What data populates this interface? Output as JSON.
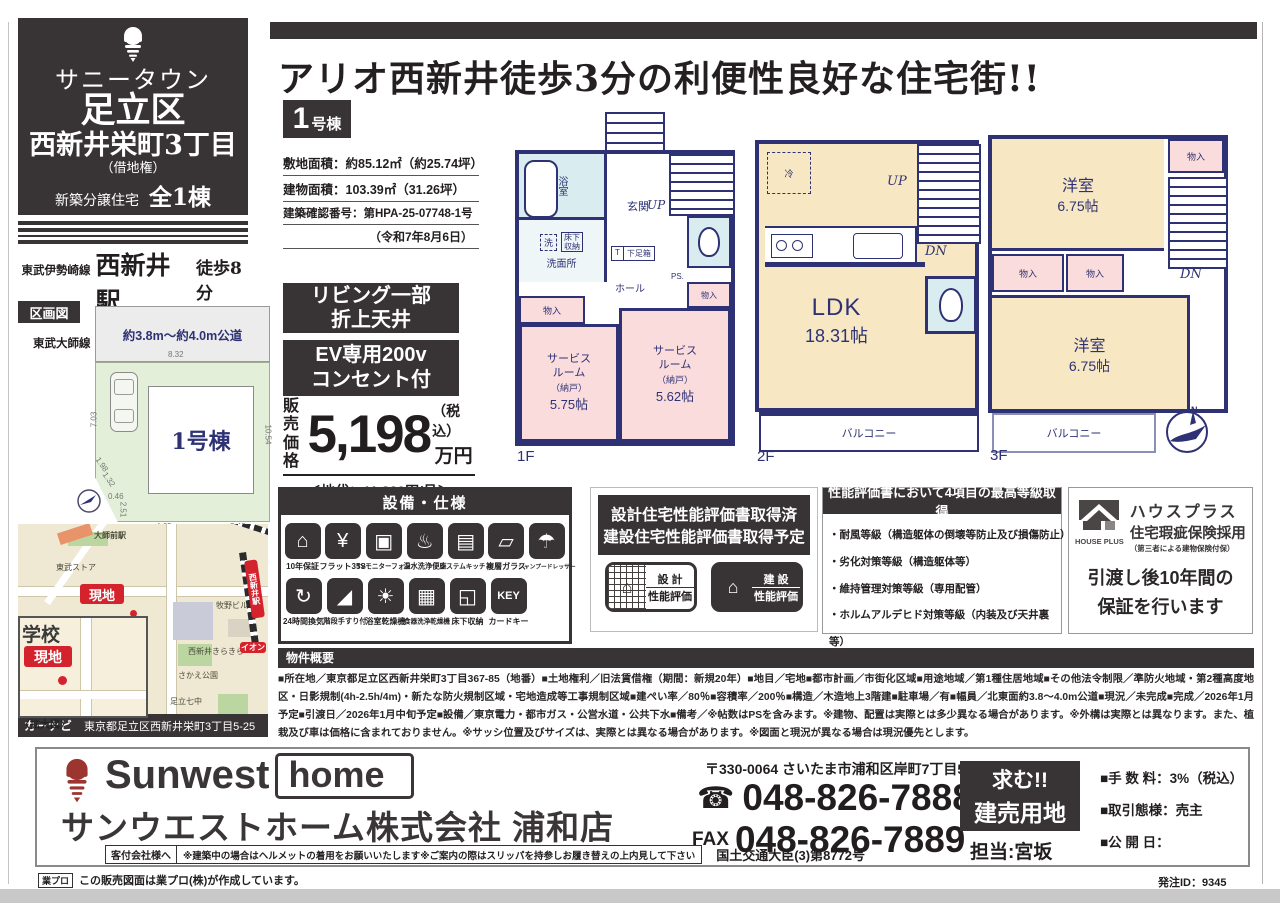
{
  "page": {
    "order_id": "発注ID：9345"
  },
  "sidebar": {
    "project_name": "サニータウン",
    "area": "足立区",
    "town": "西新井栄町3丁目",
    "leasehold": "（借地権）",
    "type_label": "新築分譲住宅",
    "total_label": "全1棟",
    "stations": [
      {
        "line": "東武伊勢崎線",
        "station": "西新井駅",
        "walk": "徒歩8分"
      },
      {
        "line": "東武大師線",
        "station": "大師前駅",
        "walk": "徒歩6分"
      }
    ],
    "plot": {
      "section_label": "区画図",
      "road_label": "約3.8m～約4.0m公道",
      "building_label": "1号棟",
      "dims": [
        "8.32",
        "7.03",
        "10.54",
        "4.65",
        "2.42",
        "1.98",
        "1.32",
        "0.46",
        "2.51"
      ]
    },
    "map": {
      "station1": "大師前駅",
      "station2": "西新井駅",
      "labels": [
        "東武ストア",
        "アーク東山クリニック",
        "牧野ビル",
        "西新井きらきら",
        "さかえ公園",
        "足立七中"
      ],
      "ion": "イオン",
      "site_label": "現地",
      "school_label": "学校",
      "enlarge_label": "〈拡大図〉",
      "navi_label": "カーナビ",
      "navi_address": "東京都足立区西新井栄町3丁目5-25"
    }
  },
  "main": {
    "headline": "アリオ西新井徒歩3分の利便性良好な住宅街!!",
    "unit_num": "1",
    "unit_suffix": "号棟",
    "specs": [
      "敷地面積：約85.12㎡（約25.74坪）",
      "建物面積：103.39㎡（31.26坪）",
      "建築確認番号：第HPA-25-07748-1号",
      "（令和7年8月6日）"
    ],
    "feature_boxes": [
      "リビング一部\n折上天井",
      "EV専用200v\nコンセント付"
    ],
    "price": {
      "label": "販売\n価格",
      "amount": "5,198",
      "tax": "（税込）",
      "unit": "万円",
      "land_rent": "＜地代：11,820円/月＞"
    }
  },
  "fp1": {
    "floor": "1F",
    "bath": "浴室",
    "wash": "洗",
    "underfloor": "床下\n収納",
    "washroom": "洗面所",
    "genkan": "玄関",
    "t": "T",
    "shoebox": "下足箱",
    "up": "UP",
    "hall": "ホール",
    "ps": "PS.",
    "closet1": "物入",
    "closet2": "物入",
    "sr1_name": "サービス\nルーム",
    "sr1_sub": "（納戸）",
    "sr1_size": "5.75帖",
    "sr2_name": "サービス\nルーム",
    "sr2_sub": "（納戸）",
    "sr2_size": "5.62帖"
  },
  "fp2": {
    "floor": "2F",
    "fridge": "冷",
    "up": "UP",
    "dn": "DN",
    "ldk_name": "LDK",
    "ldk_size": "18.31帖",
    "balcony": "バルコニー"
  },
  "fp3": {
    "floor": "3F",
    "room1_name": "洋室",
    "room1_size": "6.75帖",
    "room2_name": "洋室",
    "room2_size": "6.75帖",
    "closet1": "物入",
    "closet2": "物入",
    "closet3": "物入",
    "dn": "DN",
    "balcony": "バルコニー",
    "compass_n": "N"
  },
  "equipment": {
    "header": "設備・仕様",
    "row1": [
      {
        "label": "10年保証",
        "glyph": "⌂"
      },
      {
        "label": "フラット35S",
        "glyph": "¥"
      },
      {
        "label": "TVモニターフォン",
        "glyph": "▣"
      },
      {
        "label": "温水洗浄便座",
        "glyph": "♨"
      },
      {
        "label": "システムキッチン",
        "glyph": "▤"
      },
      {
        "label": "複層ガラス",
        "glyph": "▱"
      },
      {
        "label": "シャンプードレッサー",
        "glyph": "☂"
      }
    ],
    "row2": [
      {
        "label": "24時間換気",
        "glyph": "↻"
      },
      {
        "label": "階段手すり付",
        "glyph": "◢"
      },
      {
        "label": "浴室乾燥機",
        "glyph": "☀"
      },
      {
        "label": "食器洗浄乾燥機",
        "glyph": "▦"
      },
      {
        "label": "床下収納",
        "glyph": "◱"
      },
      {
        "label": "カードキー",
        "glyph": "KEY"
      }
    ]
  },
  "evaluation": {
    "line1": "設計住宅性能評価書取得済",
    "line2": "建設住宅性能評価書取得予定",
    "badge1_top": "設 計",
    "badge1_bottom": "性能評価",
    "badge2_top": "建 設",
    "badge2_bottom": "性能評価"
  },
  "grades": {
    "header": "性能評価書において4項目の最高等級取得",
    "items": [
      "・耐風等級（構造躯体の倒壊等防止及び損傷防止）",
      "・劣化対策等級（構造躯体等）",
      "・維持管理対策等級（専用配管）",
      "・ホルムアルデヒド対策等級（内装及び天井裏等）"
    ]
  },
  "warranty": {
    "logo_text": "HOUSE PLUS",
    "line1": "ハウスプラス",
    "line2": "住宅瑕疵保険採用",
    "line3": "（第三者による建物保険付保）",
    "body": "引渡し後10年間の\n保証を行います"
  },
  "overview": {
    "header": "物件概要",
    "text": "■所在地／東京都足立区西新井栄町3丁目367-85（地番）■土地権利／旧法賃借権（期間：新規20年）■地目／宅地■都市計画／市街化区域■用途地域／第1種住居地域■その他法令制限／準防火地域・第2種高度地区・日影規制(4h-2.5h/4m)・新たな防火規制区域・宅地造成等工事規制区域■建ぺい率／80％■容積率／200％■構造／木造地上3階建■駐車場／有■幅員／北東面約3.8～4.0m公道■現況／未完成■完成／2026年1月予定■引渡日／2026年1月中旬予定■設備／東京電力・都市ガス・公営水道・公共下水■備考／※帖数はPSを含みます。※建物、配置は実際とは多少異なる場合があります。※外構は実際とは異なります。また、植栽及び車は価格に含まれておりません。※サッシ位置及びサイズは、実際とは異なる場合があります。※図面と現況が異なる場合は現況優先とします。"
  },
  "footer": {
    "logo_en1": "Sunwest",
    "logo_en2": "home",
    "company": "サンウエストホーム株式会社 浦和店",
    "notice_label": "客付会社様へ",
    "notice": "※建築中の場合はヘルメットの着用をお願いいたします※ご案内の際はスリッパを持参しお履き替えの上内見して下さい",
    "license": "国土交通大臣(3)第8772号",
    "postal": "〒330-0064 さいたま市浦和区岸町7丁目5-4",
    "tel_icon": "☎",
    "tel": "048-826-7888",
    "fax_label": "FAX",
    "fax": "048-826-7889",
    "want_line1": "求む!!",
    "want_line2": "建売用地",
    "contact": "担当:宮坂",
    "fee": "■手 数 料：3%（税込）",
    "deal": "■取引態様：売主",
    "open_date": "■公 開 日：",
    "credit_logo": "業プロ",
    "credit": "この販売図面は業プロ(株)が作成しています。"
  },
  "colors": {
    "accent_black": "#383334",
    "plan_navy": "#2e3274",
    "room_cream": "#f7e7c2",
    "room_pink": "#fadcdc",
    "room_cyan": "#d9edf0",
    "site_red": "#d5232d"
  }
}
